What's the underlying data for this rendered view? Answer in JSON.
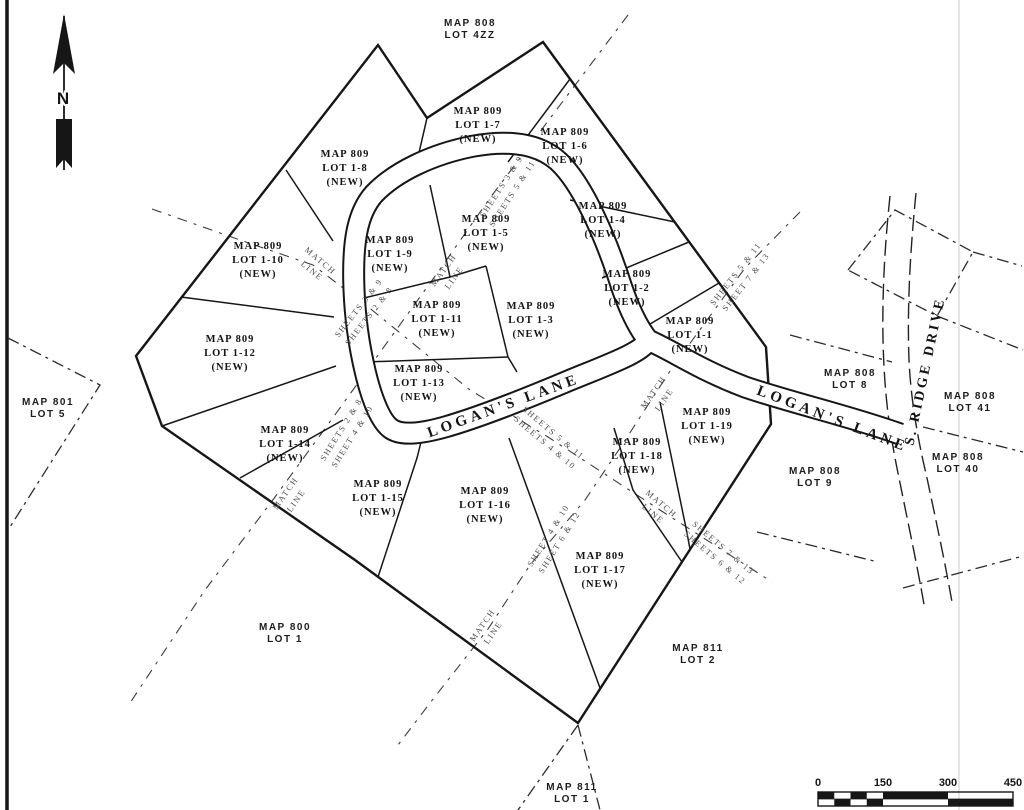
{
  "north": {
    "label": "N"
  },
  "roads": {
    "logans_lane_west": "LOGAN'S LANE",
    "logans_lane_east": "LOGAN'S LANE",
    "s_ridge_drive": "S. RIDGE DRIVE"
  },
  "lots": [
    {
      "map": "MAP 809",
      "lot": "LOT 1-7",
      "status": "(NEW)"
    },
    {
      "map": "MAP 809",
      "lot": "LOT 1-6",
      "status": "(NEW)"
    },
    {
      "map": "MAP 809",
      "lot": "LOT 1-8",
      "status": "(NEW)"
    },
    {
      "map": "MAP 809",
      "lot": "LOT 1-4",
      "status": "(NEW)"
    },
    {
      "map": "MAP 809",
      "lot": "LOT 1-5",
      "status": "(NEW)"
    },
    {
      "map": "MAP 809",
      "lot": "LOT 1-9",
      "status": "(NEW)"
    },
    {
      "map": "MAP 809",
      "lot": "LOT 1-10",
      "status": "(NEW)"
    },
    {
      "map": "MAP 809",
      "lot": "LOT 1-2",
      "status": "(NEW)"
    },
    {
      "map": "MAP 809",
      "lot": "LOT 1-11",
      "status": "(NEW)"
    },
    {
      "map": "MAP 809",
      "lot": "LOT 1-3",
      "status": "(NEW)"
    },
    {
      "map": "MAP 809",
      "lot": "LOT 1-1",
      "status": "(NEW)"
    },
    {
      "map": "MAP 809",
      "lot": "LOT 1-12",
      "status": "(NEW)"
    },
    {
      "map": "MAP 809",
      "lot": "LOT 1-13",
      "status": "(NEW)"
    },
    {
      "map": "MAP 809",
      "lot": "LOT 1-19",
      "status": "(NEW)"
    },
    {
      "map": "MAP 809",
      "lot": "LOT 1-14",
      "status": "(NEW)"
    },
    {
      "map": "MAP 809",
      "lot": "LOT 1-18",
      "status": "(NEW)"
    },
    {
      "map": "MAP 809",
      "lot": "LOT 1-15",
      "status": "(NEW)"
    },
    {
      "map": "MAP 809",
      "lot": "LOT 1-16",
      "status": "(NEW)"
    },
    {
      "map": "MAP 809",
      "lot": "LOT 1-17",
      "status": "(NEW)"
    }
  ],
  "adjacent": [
    {
      "map": "MAP 808",
      "lot": "LOT 4ZZ"
    },
    {
      "map": "MAP 801",
      "lot": "LOT 5"
    },
    {
      "map": "MAP 800",
      "lot": "LOT 1"
    },
    {
      "map": "MAP 811",
      "lot": "LOT 2"
    },
    {
      "map": "MAP 811",
      "lot": "LOT 1"
    },
    {
      "map": "MAP 808",
      "lot": "LOT 8"
    },
    {
      "map": "MAP 808",
      "lot": "LOT 41"
    },
    {
      "map": "MAP 808",
      "lot": "LOT 9"
    },
    {
      "map": "MAP 808",
      "lot": "LOT 40"
    }
  ],
  "match_labels": [
    {
      "top": "SHEETS 3 & 9",
      "bottom": "SHEETS 5 & 11"
    },
    {
      "top": "MATCH",
      "bottom": "LINE"
    },
    {
      "top": "SHEETS 3 & 9",
      "bottom": "SHEETS 2 & 8"
    },
    {
      "top": "SHEETS 2 & 8",
      "bottom": "SHEET 4 & 10"
    },
    {
      "top": "MATCH",
      "bottom": "LINE"
    },
    {
      "top": "MATCH",
      "bottom": "LINE"
    },
    {
      "top": "SHEETS 5 & 11",
      "bottom": "SHEETS 4 & 10"
    },
    {
      "top": "MATCH",
      "bottom": "LINE"
    },
    {
      "top": "SHEETS 7 & 13",
      "bottom": "SHEETS 6 & 12"
    },
    {
      "top": "SHEETS 5 & 11",
      "bottom": "SHEET 7 & 13"
    },
    {
      "top": "MATCH",
      "bottom": "LINE"
    },
    {
      "top": "SHEET 4 & 10",
      "bottom": "SHEET 6 & 12"
    },
    {
      "top": "MATCH",
      "bottom": "LINE"
    }
  ],
  "scale_bar": {
    "ticks": [
      "0",
      "150",
      "300",
      "450"
    ]
  },
  "colors": {
    "line": "#161616",
    "paper": "#ffffff",
    "muted_label": "#4d4d4d"
  }
}
